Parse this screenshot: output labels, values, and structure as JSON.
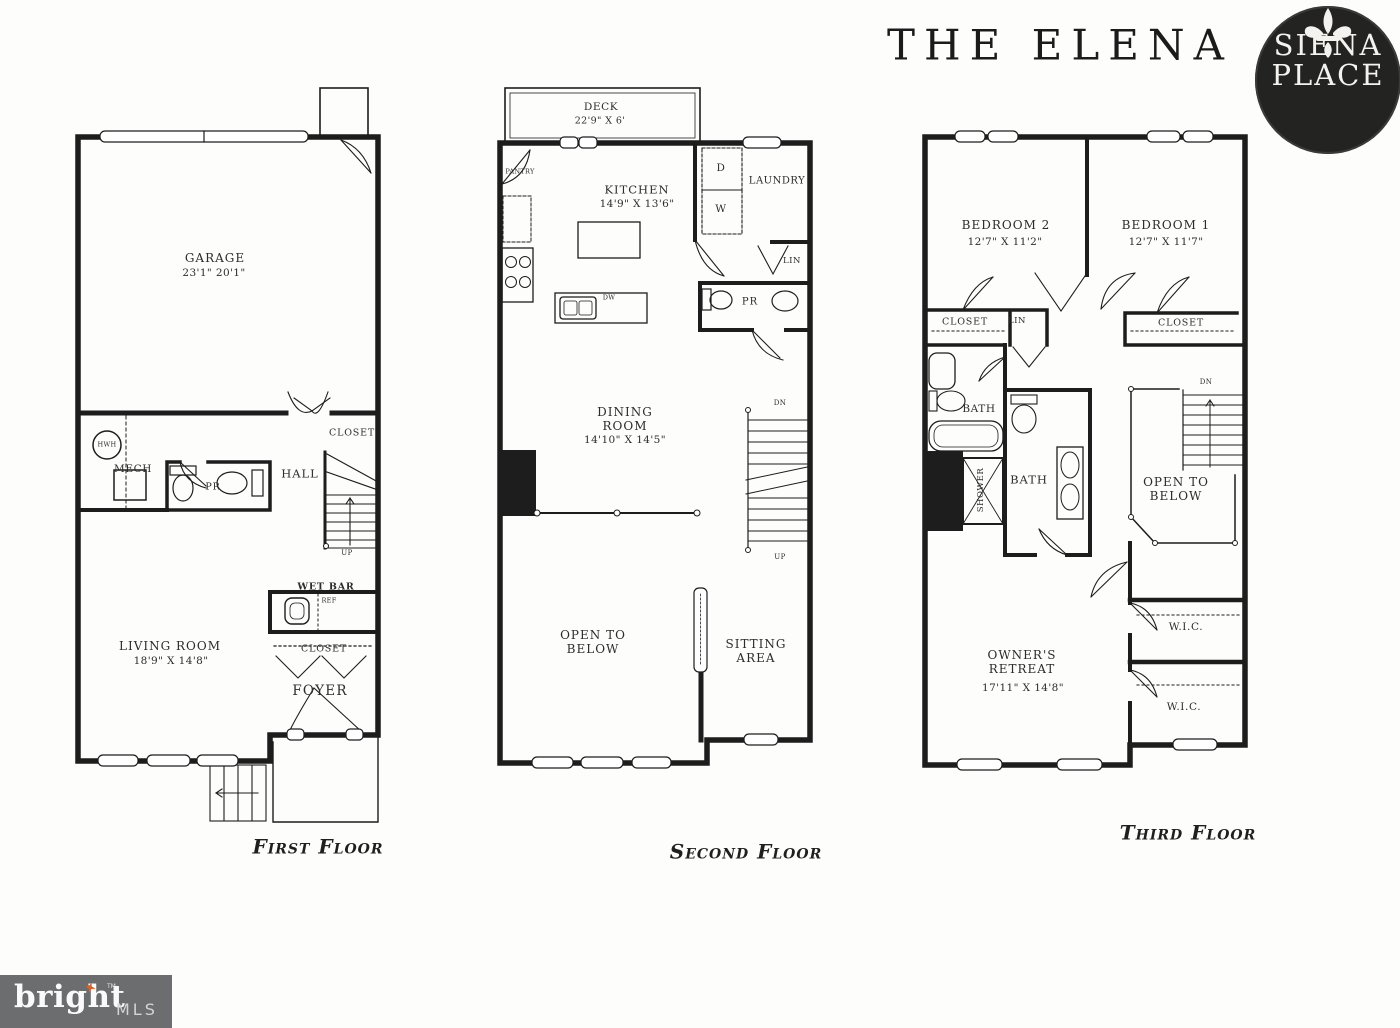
{
  "header": {
    "title": "THE ELENA",
    "badge_top": "SIENA",
    "badge_bottom": "PLACE"
  },
  "floor1": {
    "title": "First Floor",
    "garage": "GARAGE",
    "garage_dims": "23'1\" 20'1\"",
    "hwh": "HWH",
    "mech": "MECH",
    "pr": "PR",
    "hall": "HALL",
    "closet_upper": "CLOSET",
    "up": "UP",
    "wet_bar": "WET BAR",
    "ref": "REF",
    "living": "LIVING ROOM",
    "living_dims": "18'9\" X 14'8\"",
    "closet_lower": "CLOSET",
    "foyer": "FOYER"
  },
  "floor2": {
    "title": "Second Floor",
    "deck": "DECK",
    "deck_dims": "22'9\" X 6'",
    "pantry": "PANTRY",
    "kitchen": "KITCHEN",
    "kitchen_dims": "14'9\" X 13'6\"",
    "dryer": "D",
    "washer": "W",
    "laundry": "LAUNDRY",
    "lin": "LIN",
    "pr": "PR",
    "dw": "DW",
    "dining": "DINING ROOM",
    "dining_dims": "14'10\" X 14'5\"",
    "dn": "DN",
    "up": "UP",
    "open_below": "OPEN TO BELOW",
    "sitting": "SITTING AREA"
  },
  "floor3": {
    "title": "Third Floor",
    "bedroom2": "BEDROOM 2",
    "bedroom2_dims": "12'7\" X 11'2\"",
    "bedroom1": "BEDROOM 1",
    "bedroom1_dims": "12'7\" X 11'7\"",
    "closet_left": "CLOSET",
    "lin": "LIN",
    "closet_right": "CLOSET",
    "bath_upper": "BATH",
    "shower": "SHOWER",
    "bath_lower": "BATH",
    "dn": "DN",
    "open_below": "OPEN TO BELOW",
    "wic_upper": "W.I.C.",
    "wic_lower": "W.I.C.",
    "owners": "OWNER'S RETREAT",
    "owners_dims": "17'11\" X 14'8\""
  },
  "footer": {
    "brand": "bright",
    "tm": "TM",
    "mls": "MLS"
  },
  "colors": {
    "wall": "#1d1d1d",
    "badge_bg": "#232321",
    "footer_bg": "#6b6d6e",
    "accent_orange": "#dd5f2b"
  }
}
